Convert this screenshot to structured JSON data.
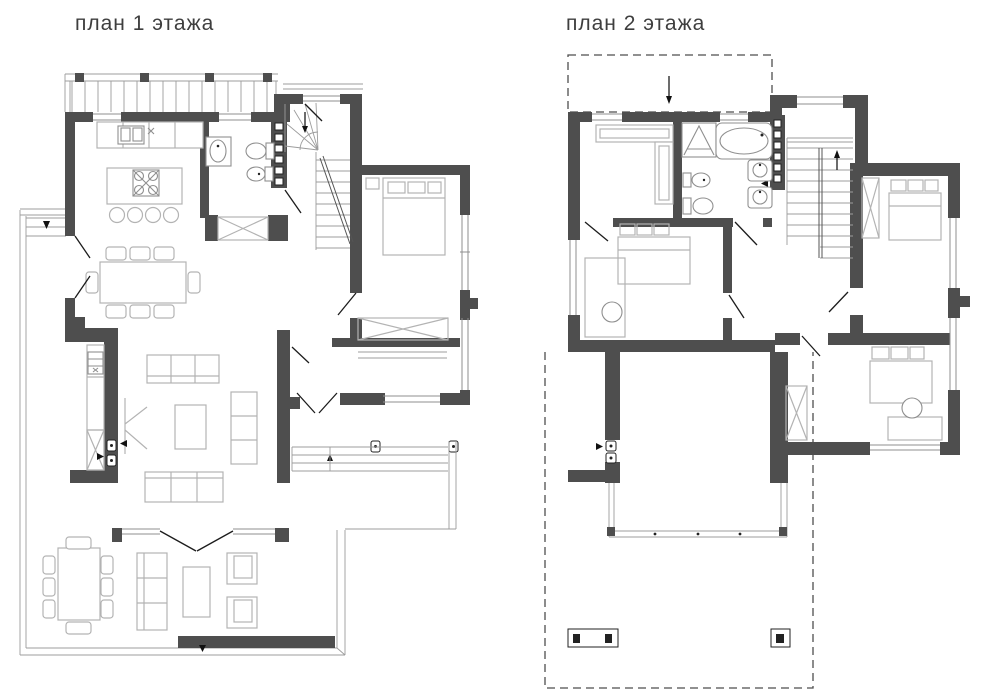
{
  "floor1": {
    "title": "план 1 этажа"
  },
  "floor2": {
    "title": "план 2 этажа"
  },
  "colors": {
    "background": "#ffffff",
    "wall": "#4e4e4e",
    "furniture": "#b3b3b3",
    "fixture": "#8f8f8f",
    "line": "#9c9c9c",
    "door": "#1c1c1c",
    "dashed": "#4e4e4e",
    "text": "#3e3e3e"
  }
}
